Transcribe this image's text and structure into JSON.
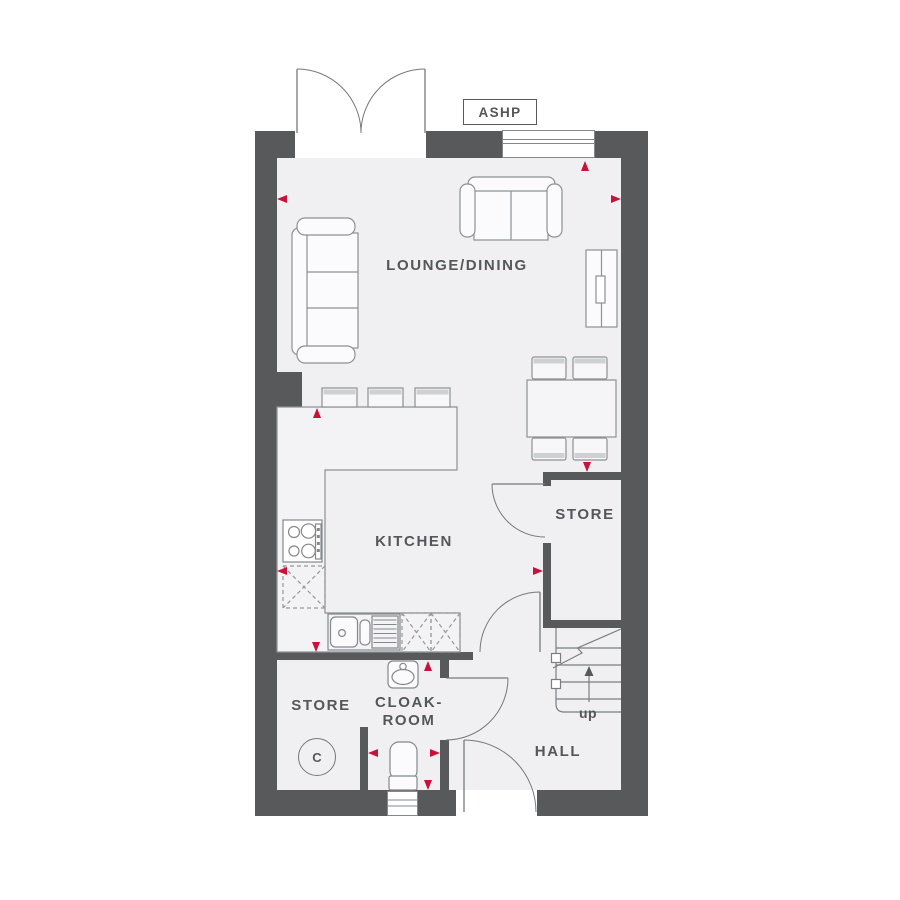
{
  "floorplan": {
    "labels": {
      "ashp": "ASHP",
      "lounge_dining": "LOUNGE/DINING",
      "kitchen": "KITCHEN",
      "store_upper": "STORE",
      "store_lower": "STORE",
      "cloakroom_line1": "CLOAK-",
      "cloakroom_line2": "ROOM",
      "hall": "HALL",
      "stairs_direction": "up",
      "cylinder_marker": "C"
    },
    "colors": {
      "wall": "#58595b",
      "floor": "#f0f0f2",
      "furniture_outline": "#8e9093",
      "door_line": "#77787b",
      "accent_red": "#c9113a",
      "label_text": "#55565a"
    },
    "fixtures": [
      "french-doors-icon",
      "window-icon",
      "sofa-3-seat-icon",
      "sofa-2-seat-icon",
      "tv-unit-icon",
      "dining-table-icon",
      "chair-icon",
      "bar-stool-icon",
      "hob-icon",
      "sink-drainer-icon",
      "appliance-space-icon",
      "washbasin-icon",
      "toilet-icon",
      "stairs-icon",
      "door-swing-icon",
      "dimension-arrow-icon",
      "cylinder-marker-icon",
      "heat-pump-unit-icon"
    ]
  }
}
